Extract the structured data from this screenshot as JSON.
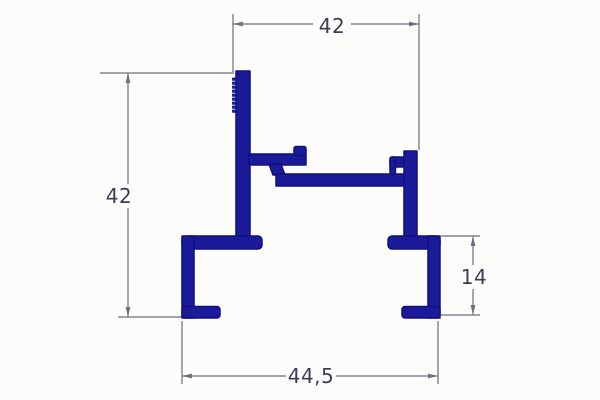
{
  "dimensions": {
    "top_width": "42",
    "left_height": "42",
    "right_foot_height": "14",
    "bottom_width": "44,5"
  },
  "colors": {
    "profile": "#1b1b99",
    "dimension_line": "#6e6e84",
    "text": "#3d3d55",
    "background": "#fcfcfa"
  }
}
